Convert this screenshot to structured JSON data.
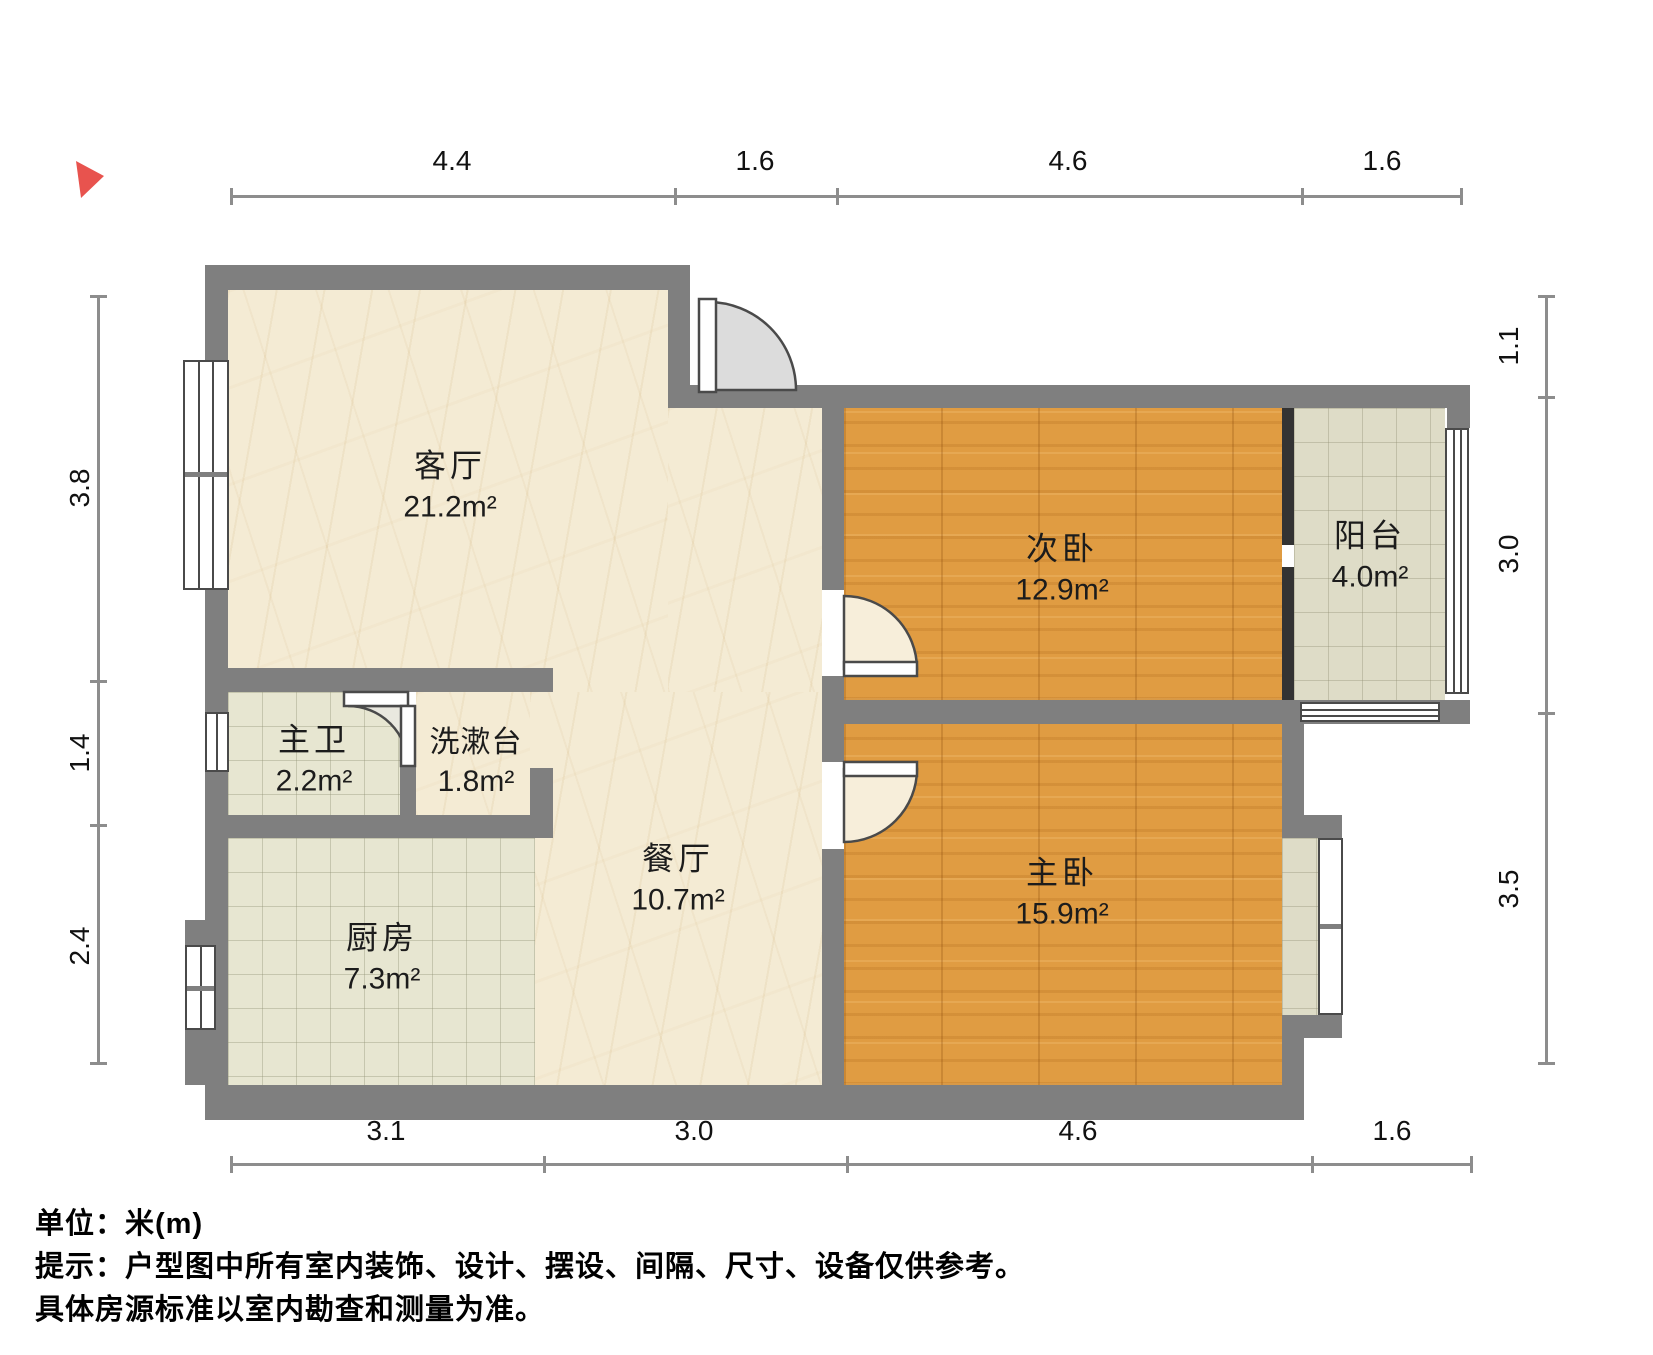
{
  "compass": {
    "color": "#e8534e"
  },
  "rooms": {
    "living": {
      "name": "客厅",
      "area": "21.2m²"
    },
    "second_bedroom": {
      "name": "次卧",
      "area": "12.9m²"
    },
    "balcony": {
      "name": "阳台",
      "area": "4.0m²"
    },
    "master_bath": {
      "name": "主卫",
      "area": "2.2m²"
    },
    "washstand": {
      "name": "洗漱台",
      "area": "1.8m²"
    },
    "dining": {
      "name": "餐厅",
      "area": "10.7m²"
    },
    "kitchen": {
      "name": "厨房",
      "area": "7.3m²"
    },
    "master_bedroom": {
      "name": "主卧",
      "area": "15.9m²"
    }
  },
  "dimensions": {
    "unit": "m",
    "top": [
      "4.4",
      "1.6",
      "4.6",
      "1.6"
    ],
    "bottom": [
      "3.1",
      "3.0",
      "4.6",
      "1.6"
    ],
    "left": [
      "3.8",
      "1.4",
      "2.4"
    ],
    "right": [
      "1.1",
      "3.0",
      "3.5"
    ]
  },
  "footer": {
    "unit": "单位：米(m)",
    "tip": "提示：户型图中所有室内装饰、设计、摆设、间隔、尺寸、设备仅供参考。",
    "tip2": "具体房源标准以室内勘查和测量为准。"
  }
}
